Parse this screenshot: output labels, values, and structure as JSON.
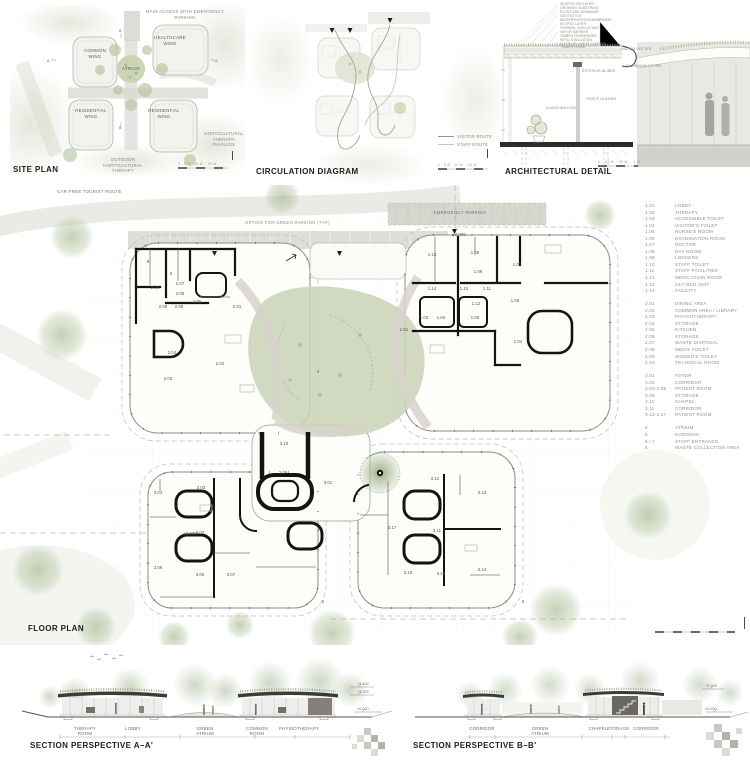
{
  "site_plan": {
    "title": "SITE PLAN",
    "access_label": "MAIN ACCESS WITH EMERGENCY\nPARKING",
    "wings": [
      {
        "label": "COMMON\nWING"
      },
      {
        "label": "HEALTHCARE\nWING"
      },
      {
        "label": "RESIDENTIAL\nWING"
      },
      {
        "label": "RESIDENTIAL\nWING"
      }
    ],
    "atrium_label": "ATRIUM",
    "pavilion_label": "HORTICULTURAL\nTHERAPY\nPAVILION",
    "outdoor_label": "OUTDOOR\nHORTICULTURAL\nTHERAPY",
    "scale_label": "0 . 5 M . 10 M .. 30 M",
    "marker_a": "A",
    "marker_b": "B"
  },
  "circulation": {
    "title": "CIRCULATION DIAGRAM",
    "legend": [
      {
        "label": "VISITOR ROUTE",
        "color": "#97978f"
      },
      {
        "label": "STAFF ROUTE",
        "color": "#c6c6be"
      }
    ],
    "scale_label": "0 . 5 M . 10 M .. 30 M"
  },
  "detail": {
    "title": "ARCHITECTURAL DETAIL",
    "layers": [
      "VEGETATION LAYER",
      "GROWING SUBSTRATE",
      "FILTER AND DRAINAGE",
      "GEOTEXTILE",
      "WATERPROOFING MEMBRANE",
      "SLOPED LAYER",
      "THERMAL INSULATION",
      "VAPOR BARRIER",
      "TIMBER FRAMEWORK",
      "INFILL INSULATION",
      "INTERIOR VAPOR CONTROL",
      "TIMBER FINISH"
    ],
    "callouts": {
      "hidden_gutter": "HIDDEN GUTTER",
      "aluminium_cover": "ALUMINIUM COVER",
      "exterior_blinds": "EXTERIOR BLINDS",
      "triple_glazing": "TRIPLE GLAZING",
      "glass_mullion": "GLASS MULLION"
    },
    "scale_label": "0 . .02 M . .05 M .. .1 M"
  },
  "floor_plan": {
    "title": "FLOOR PLAN",
    "route_label": "CAR-FREE TOURIST ROUTE",
    "parking_label": "OPTION FOR GREEN PARKING (TYP)",
    "emergency_label": "EMERGENCY PARKING",
    "scale_label": "0 . 5 M . 10 M .. 30 M",
    "rooms": [
      {
        "x": 155,
        "y": 103,
        "label": "2.10"
      },
      {
        "x": 180,
        "y": 99,
        "label": "2.07"
      },
      {
        "x": 180,
        "y": 109,
        "label": "2.06"
      },
      {
        "x": 163,
        "y": 122,
        "label": "2.09"
      },
      {
        "x": 179,
        "y": 122,
        "label": "2.08"
      },
      {
        "x": 197,
        "y": 117,
        "label": "2.05"
      },
      {
        "x": 237,
        "y": 122,
        "label": "2.01"
      },
      {
        "x": 172,
        "y": 168,
        "label": "2.04"
      },
      {
        "x": 220,
        "y": 179,
        "label": "2.02"
      },
      {
        "x": 168,
        "y": 194,
        "label": "2.03"
      },
      {
        "x": 432,
        "y": 70,
        "label": "1.13"
      },
      {
        "x": 475,
        "y": 68,
        "label": "1.08"
      },
      {
        "x": 478,
        "y": 87,
        "label": "1.09"
      },
      {
        "x": 517,
        "y": 80,
        "label": "1.07"
      },
      {
        "x": 432,
        "y": 104,
        "label": "1.14"
      },
      {
        "x": 464,
        "y": 104,
        "label": "1.10"
      },
      {
        "x": 487,
        "y": 104,
        "label": "1.11"
      },
      {
        "x": 476,
        "y": 119,
        "label": "1.12"
      },
      {
        "x": 424,
        "y": 133,
        "label": "1.03"
      },
      {
        "x": 441,
        "y": 133,
        "label": "1.04"
      },
      {
        "x": 475,
        "y": 133,
        "label": "1.05"
      },
      {
        "x": 515,
        "y": 116,
        "label": "1.06"
      },
      {
        "x": 518,
        "y": 157,
        "label": "1.02"
      },
      {
        "x": 404,
        "y": 145,
        "label": "1.01"
      },
      {
        "x": 284,
        "y": 259,
        "label": "3.10"
      },
      {
        "x": 283,
        "y": 288,
        "label": "3.09"
      },
      {
        "x": 328,
        "y": 298,
        "label": "3.01"
      },
      {
        "x": 318,
        "y": 187,
        "label": "4"
      },
      {
        "x": 201,
        "y": 303,
        "label": "3.03"
      },
      {
        "x": 158,
        "y": 308,
        "label": "3.04"
      },
      {
        "x": 200,
        "y": 348,
        "label": "3.02"
      },
      {
        "x": 158,
        "y": 383,
        "label": "3.08"
      },
      {
        "x": 200,
        "y": 390,
        "label": "3.05"
      },
      {
        "x": 231,
        "y": 390,
        "label": "3.07"
      },
      {
        "x": 435,
        "y": 294,
        "label": "3.12"
      },
      {
        "x": 482,
        "y": 308,
        "label": "3.13"
      },
      {
        "x": 392,
        "y": 343,
        "label": "3.17"
      },
      {
        "x": 437,
        "y": 346,
        "label": "3.11"
      },
      {
        "x": 482,
        "y": 385,
        "label": "3.14"
      },
      {
        "x": 441,
        "y": 389,
        "label": "3.15"
      },
      {
        "x": 408,
        "y": 388,
        "label": "3.16"
      },
      {
        "x": 190,
        "y": 349,
        "label": "±0,000"
      },
      {
        "x": 459,
        "y": 50,
        "label": "±0,000"
      },
      {
        "x": 171,
        "y": 89,
        "label": "6"
      },
      {
        "x": 201,
        "y": 89,
        "label": "7"
      },
      {
        "x": 148,
        "y": 77,
        "label": "8"
      },
      {
        "x": 323,
        "y": 417,
        "label": "5"
      },
      {
        "x": 523,
        "y": 417,
        "label": "5"
      }
    ]
  },
  "legend": {
    "groups": [
      {
        "items": [
          {
            "code": "1.01",
            "label": "LOBBY"
          },
          {
            "code": "1.02",
            "label": "THERAPY"
          },
          {
            "code": "1.03",
            "label": "ACCESSIBLE TOILET"
          },
          {
            "code": "1.04",
            "label": "VISITOR'S TOILET"
          },
          {
            "code": "1.05",
            "label": "NURSE'S ROOM"
          },
          {
            "code": "1.06",
            "label": "EXAMINATION ROOM"
          },
          {
            "code": "1.07",
            "label": "DOCTOR"
          },
          {
            "code": "1.08",
            "label": "DAY ROOM"
          },
          {
            "code": "1.09",
            "label": "LOCKERS"
          },
          {
            "code": "1.10",
            "label": "STAFF TOILET"
          },
          {
            "code": "1.11",
            "label": "STAFF FACILITIES"
          },
          {
            "code": "1.12",
            "label": "MEDICATION ROOM"
          },
          {
            "code": "1.13",
            "label": "24/7 BED UNIT"
          },
          {
            "code": "1.14",
            "label": "FACILITY"
          }
        ]
      },
      {
        "items": [
          {
            "code": "2.01",
            "label": "DINING AREA"
          },
          {
            "code": "2.02",
            "label": "COMMON AREA / LIBRARY"
          },
          {
            "code": "2.03",
            "label": "PHYSIOTHERAPY"
          },
          {
            "code": "2.04",
            "label": "STORAGE"
          },
          {
            "code": "2.05",
            "label": "KITCHEN"
          },
          {
            "code": "2.06",
            "label": "STORAGE"
          },
          {
            "code": "2.07",
            "label": "WASTE DISPOSAL"
          },
          {
            "code": "2.08",
            "label": "MEN'S TOILET"
          },
          {
            "code": "2.09",
            "label": "WOMEN'S TOILET"
          },
          {
            "code": "2.10",
            "label": "TECHNICAL ROOM"
          }
        ]
      },
      {
        "items": [
          {
            "code": "3.01",
            "label": "FOYER"
          },
          {
            "code": "3.02",
            "label": "CORRIDOR"
          },
          {
            "code": "3.03-3.08",
            "label": "PATIENT ROOM"
          },
          {
            "code": "3.09",
            "label": "STORAGE"
          },
          {
            "code": "3.10",
            "label": "CHAPEL"
          },
          {
            "code": "3.11",
            "label": "CORRIDOR"
          },
          {
            "code": "3.12-3.17",
            "label": "PATIENT ROOM"
          }
        ]
      },
      {
        "items": [
          {
            "code": "4",
            "label": "ATRIUM"
          },
          {
            "code": "5",
            "label": "GARDENS"
          },
          {
            "code": "6 / 7",
            "label": "STAFF ENTRANCE"
          },
          {
            "code": "8",
            "label": "WASTE COLLECTION AREA"
          }
        ]
      }
    ]
  },
  "sections": {
    "a": {
      "title": "SECTION PERSPECTIVE A–A'",
      "labels": [
        {
          "x": 85,
          "label": "THERAPY\nROOM"
        },
        {
          "x": 133,
          "label": "LOBBY"
        },
        {
          "x": 205,
          "label": "GREEN ATRIUM"
        },
        {
          "x": 257,
          "label": "COMMON\nROOM"
        },
        {
          "x": 299,
          "label": "PHYSIOTHERAPY"
        }
      ],
      "levels": [
        {
          "y": 683,
          "label": "+4,400"
        },
        {
          "y": 691,
          "label": "+3,200"
        },
        {
          "y": 708,
          "label": "±0,000"
        }
      ]
    },
    "b": {
      "title": "SECTION PERSPECTIVE B–B'",
      "labels": [
        {
          "x": 482,
          "label": "CORRIDOR"
        },
        {
          "x": 540,
          "label": "GREEN ATRIUM"
        },
        {
          "x": 598,
          "label": "CHAPEL"
        },
        {
          "x": 618,
          "label": "STORAGE"
        },
        {
          "x": 646,
          "label": "CORRIDOR"
        }
      ],
      "levels": [
        {
          "y": 685,
          "label": "+3,200"
        },
        {
          "y": 708,
          "label": "±0,000"
        }
      ]
    }
  }
}
